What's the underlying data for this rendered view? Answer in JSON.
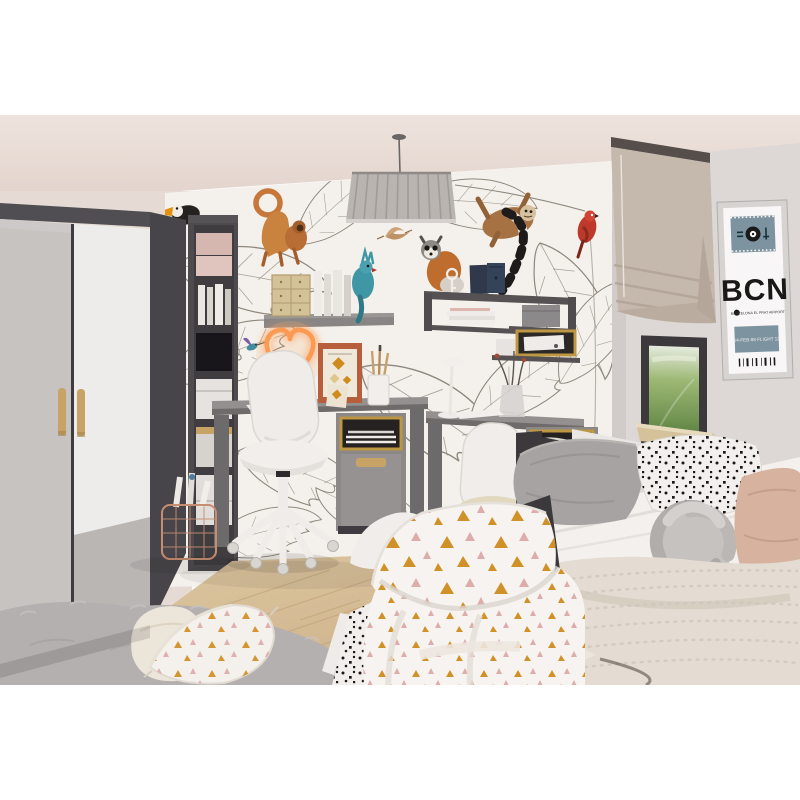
{
  "meta": {
    "alt": "3D-rendered children's room: grey wardrobe, jungle-animal wallpaper, two grey desks with white swivel chairs, neon heart lamp, pleated pendant lamp, window with taupe roman blind, BCN airport-tag poster, daybed with grey/polka-dot/knot pillows and a bed with triangle-print bedding"
  },
  "poster": {
    "code": "BCN",
    "subtitle": "BARCELONA EL PRAT AIRPORT",
    "tag": "14-FEB-88 FLIGHT 12"
  },
  "colors": {
    "ceiling1": "#efe5df",
    "ceiling2": "#e6d9d2",
    "wall_left": "#e9ded8",
    "wall_back": "#f7f4ef",
    "wall_right": "#dfdbd8",
    "line": "#8f897f",
    "wardrobe_frame": "#47464a",
    "door_grey": "#c8c6c4",
    "door_white": "#f1f0ee",
    "door_band": "#b9b7b5",
    "handle": "#c9a768",
    "shelf_dark": "#4e4c4f",
    "desk_body": "#8c8a89",
    "desk_top": "#949291",
    "desk_dark": "#6e6c6d",
    "gold": "#c09a44",
    "niche": "#242221",
    "chair": "#f2f0ed",
    "cushion": "#e5dcc2",
    "lamp": "#bcb7b3",
    "neon": "#ff9c52",
    "blind": "#c7bcb0",
    "blind_rail": "#564f4b",
    "window_frame": "#3b3a3c",
    "greenery": "#7da05a",
    "sill": "#d8c59e",
    "poster_band": "#7e96a3",
    "poster_text": "#1a1918",
    "floor": "#d8c19a",
    "plank": "#bfa479",
    "rug": "#b5b3b2",
    "mattress": "#f6f4f1",
    "pillow_grey": "#a8a6a5",
    "dot_ink": "#191818",
    "knot": "#c7c5c3",
    "blush": "#d9b5a2",
    "knit": "#e7e0d6",
    "bed_frame": "#3b3a3c",
    "mustard": "#d28e1e",
    "pink": "#dfacab"
  }
}
